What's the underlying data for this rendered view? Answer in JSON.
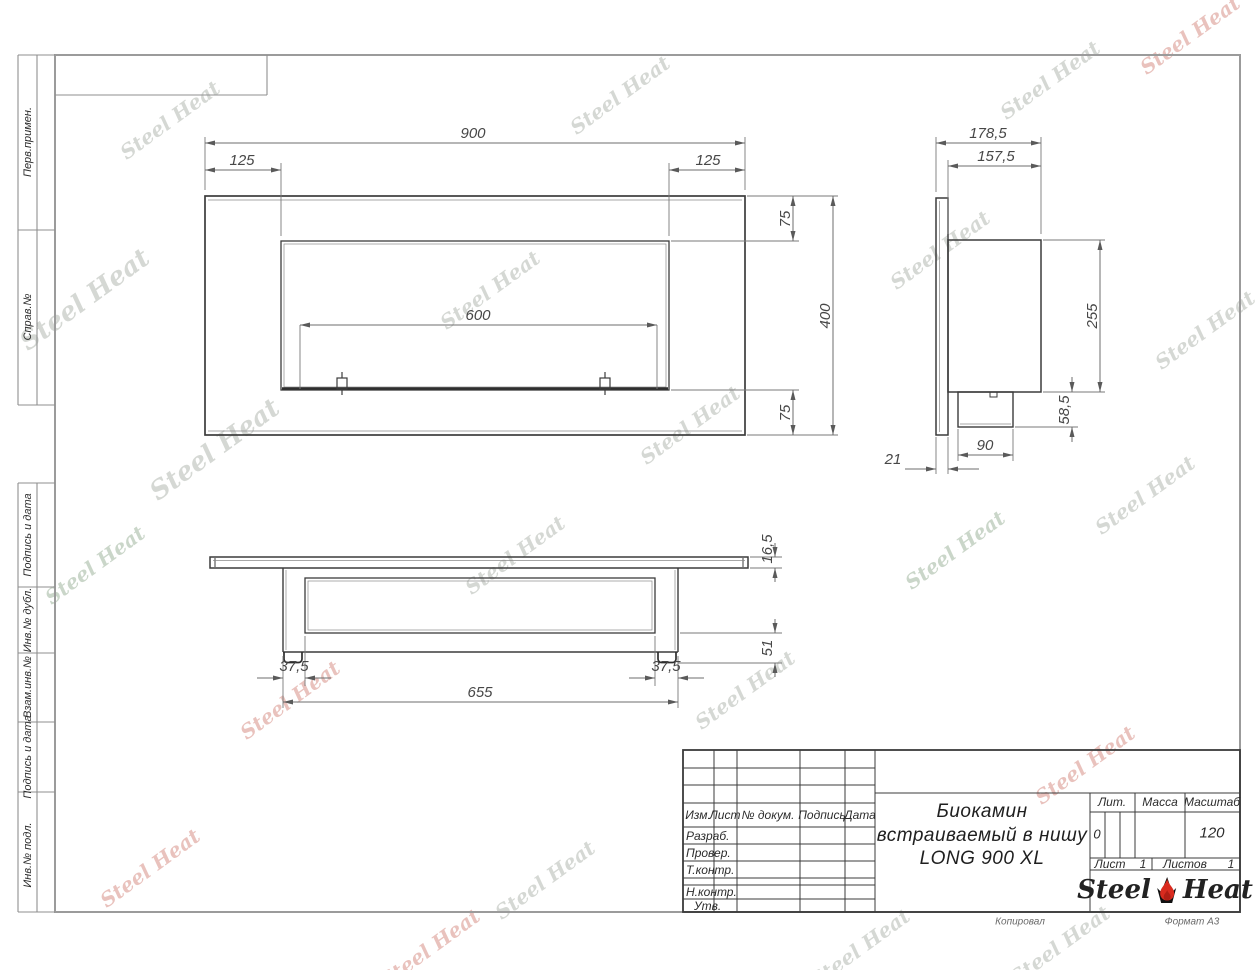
{
  "watermark": {
    "text": "Steel Heat"
  },
  "left_strip": {
    "labels": [
      "Перв.примен.",
      "Справ.№",
      "Подпись и дата",
      "Инв.№ дубл.",
      "Взам.инв.№",
      "Подпись и дата",
      "Инв.№ подл."
    ]
  },
  "views": {
    "front": {
      "dims": {
        "overall_width": "900",
        "side_inset_left": "125",
        "side_inset_right": "125",
        "burner_length": "600",
        "top_inset": "75",
        "overall_height": "400",
        "bottom_inset": "75"
      }
    },
    "side": {
      "dims": {
        "overall_depth": "178,5",
        "body_depth": "157,5",
        "body_height": "255",
        "tank_height": "58,5",
        "tank_width": "90",
        "panel_thickness": "21"
      }
    },
    "bottom": {
      "dims": {
        "plate_thickness": "16,5",
        "lower_height": "51",
        "foot_offset_left": "37,5",
        "foot_offset_right": "37,5",
        "body_length": "655"
      }
    }
  },
  "title_block": {
    "columns": {
      "izm": "Изм.",
      "list": "Лист",
      "doc": "№ докум.",
      "sign": "Подпись",
      "date": "Дата"
    },
    "rows": {
      "developed": "Разраб.",
      "checked": "Провер.",
      "tcontrol": "Т.контр.",
      "ncontrol": "Н.контр.",
      "approved": "Утв."
    },
    "product": {
      "line1": "Биокамин",
      "line2": "встраиваемый в нишу",
      "line3": "LONG 900 XL"
    },
    "right": {
      "lit_label": "Лит.",
      "lit_value": "0",
      "mass_label": "Масса",
      "scale_label": "Масштаб",
      "scale_value": "120",
      "sheet_label": "Лист",
      "sheet_value": "1",
      "sheets_label": "Листов",
      "sheets_value": "1"
    },
    "brand": {
      "word1": "Steel",
      "word2": "Heat"
    }
  },
  "footer": {
    "copied": "Копировал",
    "format": "Формат А3"
  }
}
